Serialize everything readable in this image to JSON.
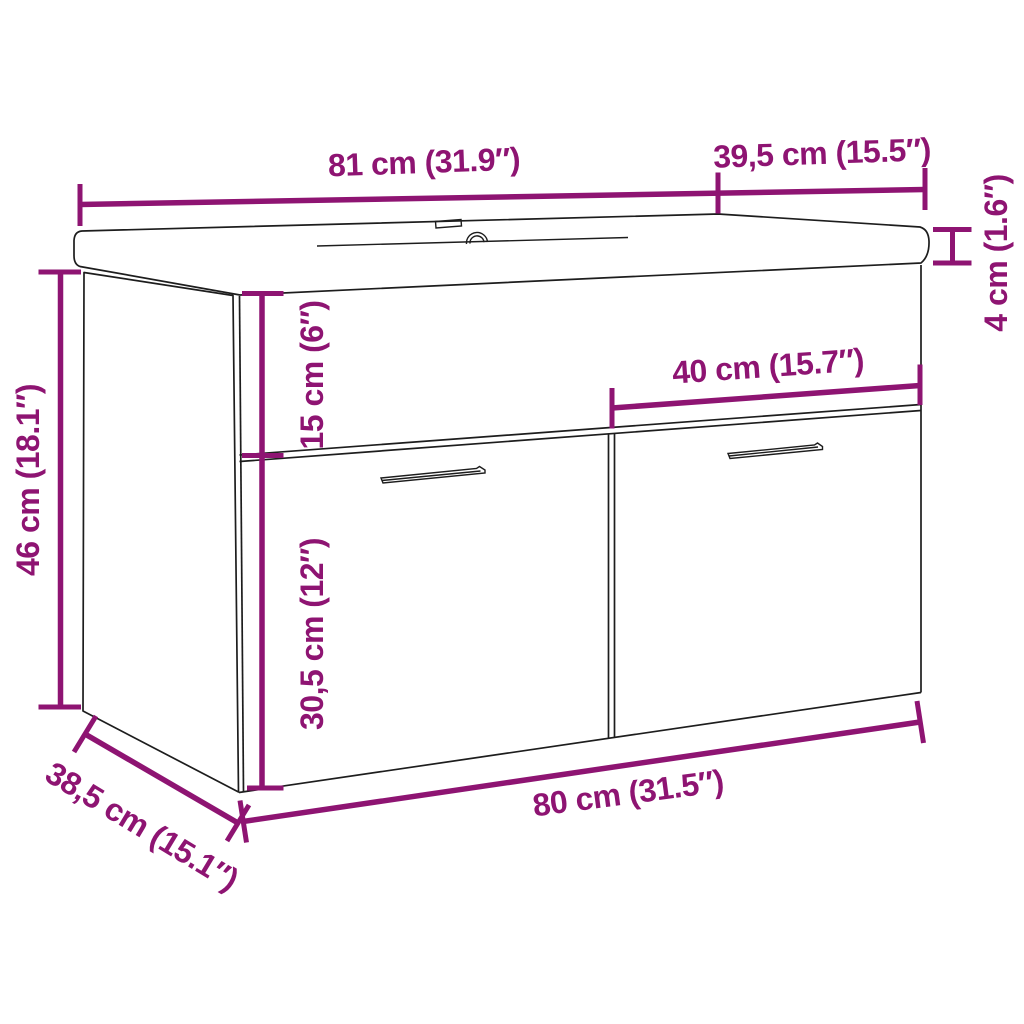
{
  "diagram": {
    "subject": "3D outline drawing of a wall-hung two-door sink cabinet with sink top",
    "accent_color": "#8E1472",
    "line_color": "#1D1D1D",
    "background_color": "#FFFFFF",
    "dimensions": [
      {
        "name": "sink_top_width",
        "label": "81 cm (31.9″)"
      },
      {
        "name": "sink_top_depth",
        "label": "39,5 cm (15.5″)"
      },
      {
        "name": "sink_top_thickness",
        "label": "4 cm (1.6″)"
      },
      {
        "name": "cabinet_height",
        "label": "46 cm (18.1″)"
      },
      {
        "name": "upper_panel_height",
        "label": "15 cm (6″)"
      },
      {
        "name": "door_width",
        "label": "40 cm (15.7″)"
      },
      {
        "name": "door_height",
        "label": "30,5 cm (12″)"
      },
      {
        "name": "cabinet_width",
        "label": "80 cm (31.5″)"
      },
      {
        "name": "cabinet_depth",
        "label": "38,5 cm (15.1″)"
      }
    ]
  }
}
